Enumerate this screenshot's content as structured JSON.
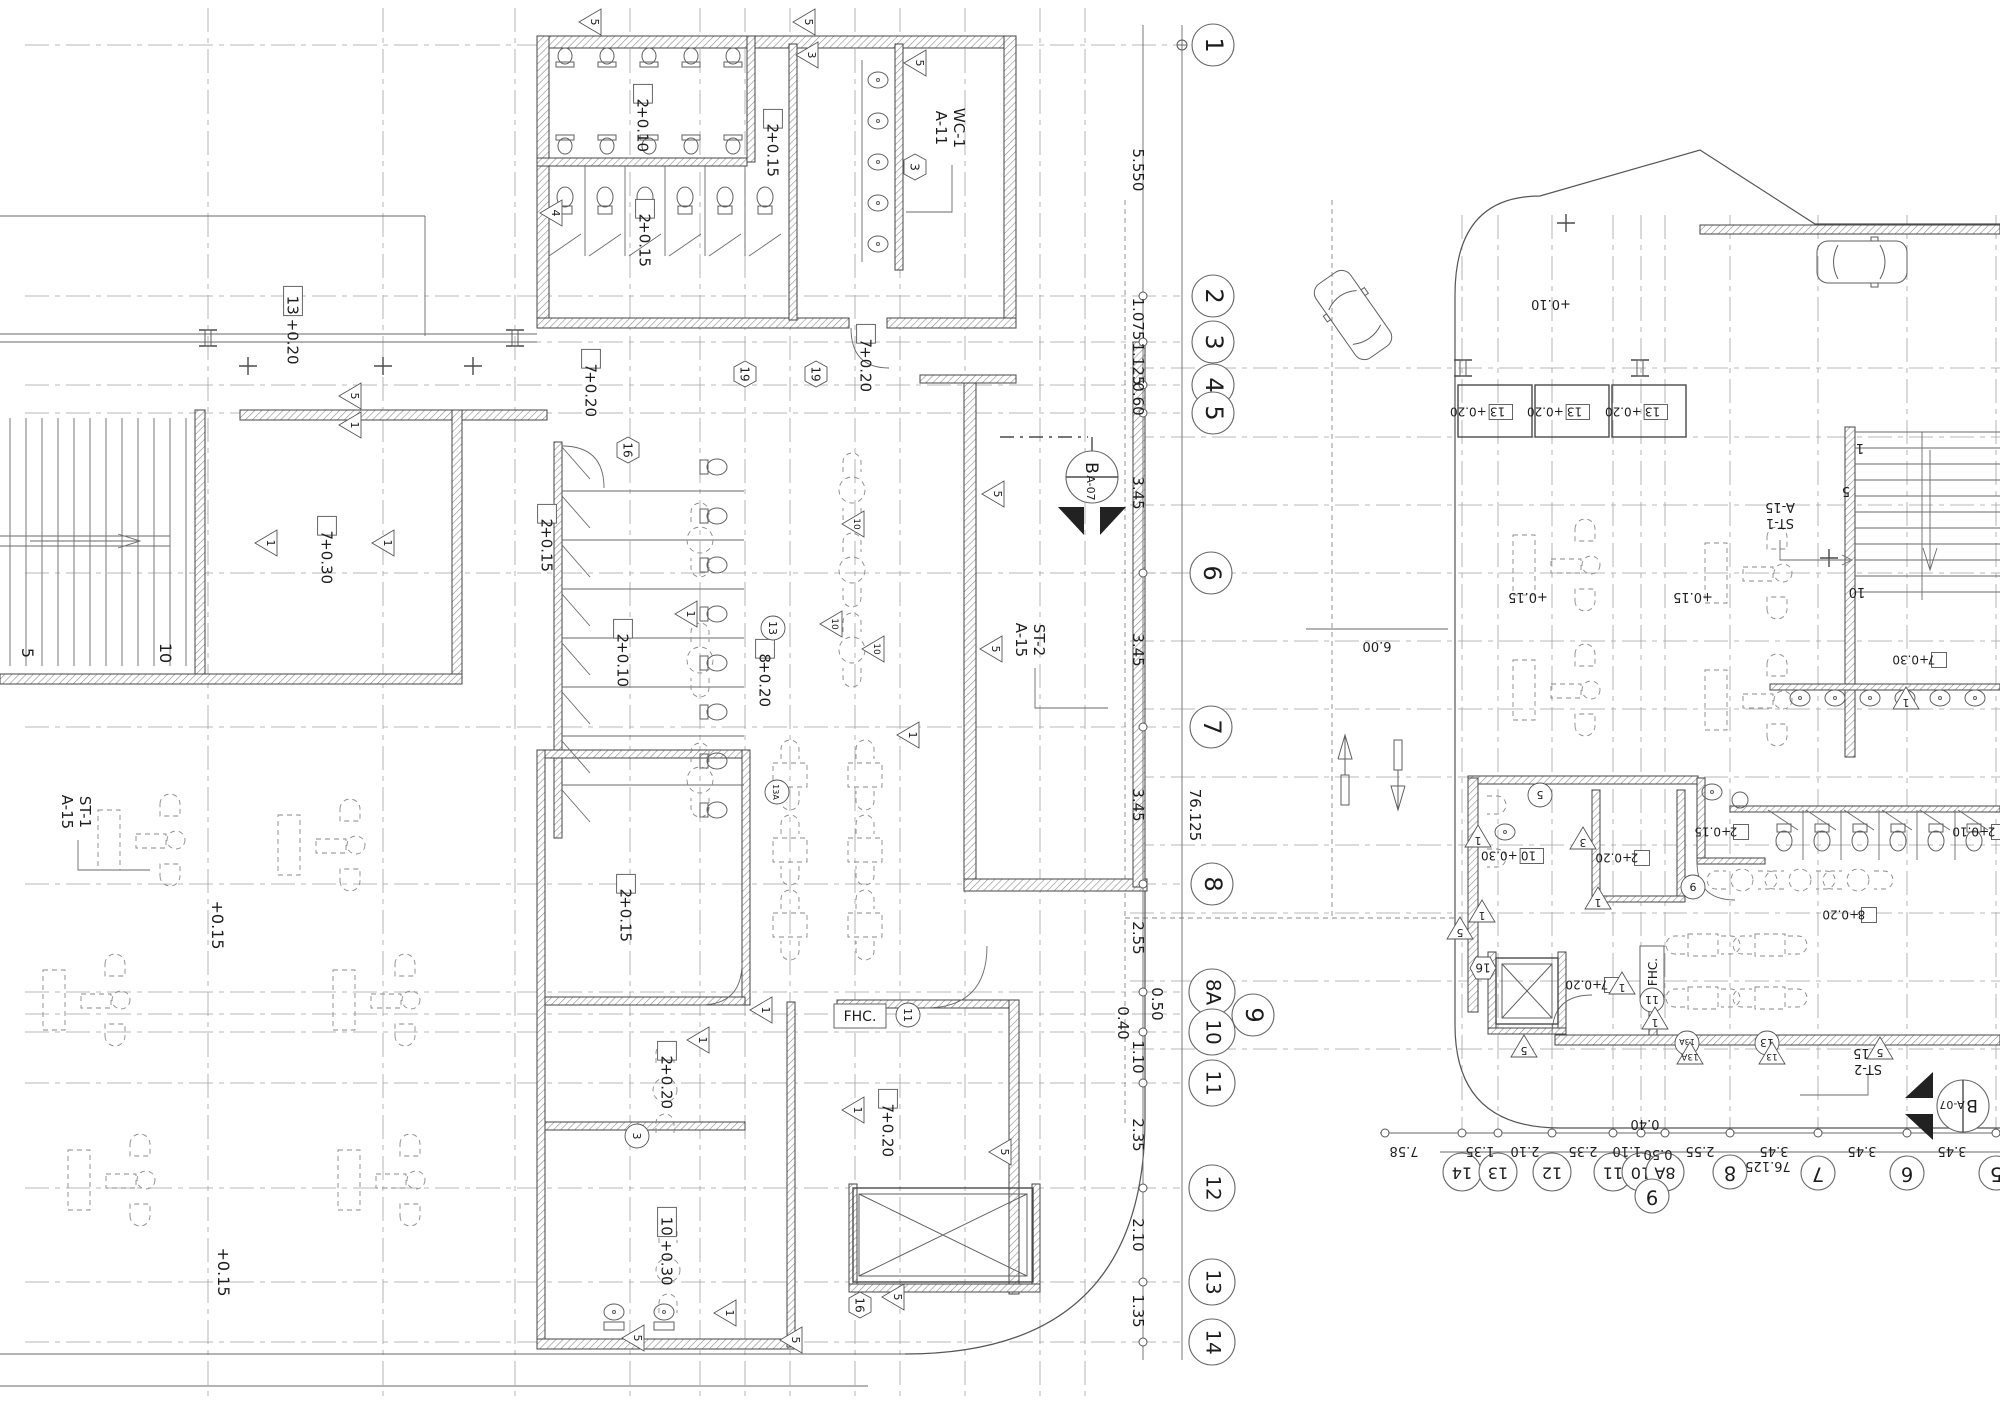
{
  "drawing": {
    "left_plan": {
      "grid_bubbles": [
        {
          "n": "1",
          "x": 1213,
          "y": 45
        },
        {
          "n": "2",
          "x": 1213,
          "y": 296
        },
        {
          "n": "3",
          "x": 1213,
          "y": 342
        },
        {
          "n": "4",
          "x": 1213,
          "y": 385
        },
        {
          "n": "5",
          "x": 1213,
          "y": 413
        },
        {
          "n": "6",
          "x": 1211,
          "y": 573
        },
        {
          "n": "7",
          "x": 1211,
          "y": 727
        },
        {
          "n": "8",
          "x": 1212,
          "y": 884
        },
        {
          "n": "8A",
          "x": 1212,
          "y": 992
        },
        {
          "n": "9",
          "x": 1253,
          "y": 1015
        },
        {
          "n": "10",
          "x": 1212,
          "y": 1032
        },
        {
          "n": "11",
          "x": 1212,
          "y": 1083
        },
        {
          "n": "12",
          "x": 1212,
          "y": 1188
        },
        {
          "n": "13",
          "x": 1212,
          "y": 1282
        },
        {
          "n": "14",
          "x": 1212,
          "y": 1342
        }
      ],
      "dim_labels": [
        {
          "t": "5.550",
          "x": 1133,
          "y": 170
        },
        {
          "t": "1.075",
          "x": 1133,
          "y": 319
        },
        {
          "t": "1.125",
          "x": 1133,
          "y": 364
        },
        {
          "t": "0.60",
          "x": 1133,
          "y": 399
        },
        {
          "t": "3.45",
          "x": 1133,
          "y": 493
        },
        {
          "t": "3.45",
          "x": 1133,
          "y": 650
        },
        {
          "t": "3.45",
          "x": 1133,
          "y": 805
        },
        {
          "t": "2.55",
          "x": 1133,
          "y": 938
        },
        {
          "t": "0.50",
          "x": 1152,
          "y": 1004
        },
        {
          "t": "0.40",
          "x": 1118,
          "y": 1023
        },
        {
          "t": "1.10",
          "x": 1133,
          "y": 1057
        },
        {
          "t": "2.35",
          "x": 1133,
          "y": 1135
        },
        {
          "t": "2.10",
          "x": 1133,
          "y": 1235
        },
        {
          "t": "1.35",
          "x": 1133,
          "y": 1311
        }
      ],
      "overall_dim": {
        "t": "76.125",
        "x": 1190,
        "y": 815
      },
      "elev_labels": [
        {
          "box": "13",
          "t": "+0.20",
          "x": 293,
          "y": 307
        },
        {
          "box": "2",
          "t": "+0.10",
          "x": 643,
          "y": 105
        },
        {
          "box": "2",
          "t": "+0.15",
          "x": 773,
          "y": 130
        },
        {
          "box": "2",
          "t": "+0.15",
          "x": 645,
          "y": 220
        },
        {
          "box": "7",
          "t": "+0.20",
          "x": 591,
          "y": 370
        },
        {
          "box": "7",
          "t": "+0.20",
          "x": 866,
          "y": 345
        },
        {
          "box": "2",
          "t": "+0.15",
          "x": 547,
          "y": 525
        },
        {
          "box": "7",
          "t": "+0.30",
          "x": 327,
          "y": 537
        },
        {
          "box": "2",
          "t": "+0.10",
          "x": 623,
          "y": 640
        },
        {
          "box": "8",
          "t": "+0.20",
          "x": 765,
          "y": 660
        },
        {
          "box": "2",
          "t": "+0.15",
          "x": 626,
          "y": 895
        },
        {
          "box": "2",
          "t": "+0.20",
          "x": 667,
          "y": 1062
        },
        {
          "box": "7",
          "t": "+0.20",
          "x": 888,
          "y": 1110
        },
        {
          "box": "10",
          "t": "+0.30",
          "x": 667,
          "y": 1228
        }
      ],
      "plain_labels": [
        {
          "t": "+0.15",
          "x": 212,
          "y": 925
        },
        {
          "t": "+0.15",
          "x": 218,
          "y": 1272
        },
        {
          "t": "5",
          "x": 22,
          "y": 653
        },
        {
          "t": "10",
          "x": 160,
          "y": 653
        }
      ],
      "ref_labels": [
        {
          "l1": "WC-1",
          "l2": "A-11",
          "x": 952,
          "y": 128
        },
        {
          "l1": "ST-2",
          "l2": "A-15",
          "x": 1032,
          "y": 640
        },
        {
          "l1": "ST-1",
          "l2": "A-15",
          "x": 78,
          "y": 812
        }
      ],
      "box_labels": [
        {
          "t": "FHC.",
          "x": 860,
          "y": 1016
        }
      ],
      "hex_tags": [
        {
          "t": "3",
          "x": 915,
          "y": 167
        },
        {
          "t": "19",
          "x": 745,
          "y": 374
        },
        {
          "t": "19",
          "x": 816,
          "y": 374
        },
        {
          "t": "16",
          "x": 628,
          "y": 450
        },
        {
          "t": "16",
          "x": 860,
          "y": 1305
        }
      ],
      "circle_tags": [
        {
          "t": "11",
          "x": 908,
          "y": 1015
        },
        {
          "t": "3",
          "x": 637,
          "y": 1136
        },
        {
          "t": "13",
          "x": 773,
          "y": 628
        },
        {
          "t": "13A",
          "x": 777,
          "y": 792
        }
      ],
      "tri_tags": [
        {
          "t": "5",
          "x": 592,
          "y": 22
        },
        {
          "t": "5",
          "x": 806,
          "y": 22
        },
        {
          "t": "3",
          "x": 809,
          "y": 55
        },
        {
          "t": "5",
          "x": 917,
          "y": 63
        },
        {
          "t": "4",
          "x": 553,
          "y": 213
        },
        {
          "t": "5",
          "x": 352,
          "y": 396
        },
        {
          "t": "1",
          "x": 352,
          "y": 425
        },
        {
          "t": "1",
          "x": 268,
          "y": 543
        },
        {
          "t": "1",
          "x": 385,
          "y": 543
        },
        {
          "t": "1",
          "x": 688,
          "y": 614
        },
        {
          "t": "10",
          "x": 855,
          "y": 524
        },
        {
          "t": "10",
          "x": 833,
          "y": 624
        },
        {
          "t": "10",
          "x": 875,
          "y": 649
        },
        {
          "t": "5",
          "x": 995,
          "y": 494
        },
        {
          "t": "5",
          "x": 993,
          "y": 649
        },
        {
          "t": "1",
          "x": 910,
          "y": 735
        },
        {
          "t": "1",
          "x": 763,
          "y": 1010
        },
        {
          "t": "1",
          "x": 700,
          "y": 1040
        },
        {
          "t": "1",
          "x": 855,
          "y": 1110
        },
        {
          "t": "5",
          "x": 1002,
          "y": 1152
        },
        {
          "t": "1",
          "x": 727,
          "y": 1313
        },
        {
          "t": "5",
          "x": 635,
          "y": 1338
        },
        {
          "t": "5",
          "x": 793,
          "y": 1340
        },
        {
          "t": "5",
          "x": 895,
          "y": 1297
        }
      ],
      "section_marker": {
        "top": "B",
        "bottom": "A-07",
        "x": 1092,
        "y": 477
      }
    },
    "right_plan": {
      "grid_bubbles": [
        {
          "n": "14",
          "x": 1462,
          "y": 1172
        },
        {
          "n": "13",
          "x": 1498,
          "y": 1172
        },
        {
          "n": "12",
          "x": 1552,
          "y": 1172
        },
        {
          "n": "11",
          "x": 1613,
          "y": 1172
        },
        {
          "n": "10",
          "x": 1641,
          "y": 1172
        },
        {
          "n": "8A",
          "x": 1665,
          "y": 1172
        },
        {
          "n": "9",
          "x": 1652,
          "y": 1196
        },
        {
          "n": "8",
          "x": 1730,
          "y": 1172
        },
        {
          "n": "7",
          "x": 1818,
          "y": 1173
        },
        {
          "n": "6",
          "x": 1907,
          "y": 1173
        },
        {
          "n": "5",
          "x": 1996,
          "y": 1173
        }
      ],
      "dim_labels": [
        {
          "t": "7.58",
          "x": 1404,
          "y": 1147
        },
        {
          "t": "1.35",
          "x": 1480,
          "y": 1147
        },
        {
          "t": "2.10",
          "x": 1525,
          "y": 1147
        },
        {
          "t": "2.35",
          "x": 1583,
          "y": 1147
        },
        {
          "t": "1.10",
          "x": 1627,
          "y": 1147
        },
        {
          "t": "0.40",
          "x": 1645,
          "y": 1120
        },
        {
          "t": "0.50",
          "x": 1658,
          "y": 1150
        },
        {
          "t": "2.55",
          "x": 1700,
          "y": 1147
        },
        {
          "t": "3.45",
          "x": 1774,
          "y": 1147
        },
        {
          "t": "3.45",
          "x": 1862,
          "y": 1147
        },
        {
          "t": "3.45",
          "x": 1952,
          "y": 1147
        }
      ],
      "overall_dim": {
        "t": "76.125",
        "x": 1768,
        "y": 1162
      },
      "elev_labels": [
        {
          "box": "13",
          "t": "+0.20",
          "x": 1496,
          "y": 412
        },
        {
          "box": "13",
          "t": "+0.20",
          "x": 1573,
          "y": 412
        },
        {
          "box": "13",
          "t": "+0.20",
          "x": 1651,
          "y": 412
        },
        {
          "box": "7",
          "t": "+0.30",
          "x": 1930,
          "y": 660
        },
        {
          "box": "10",
          "t": "+0.30",
          "x": 1527,
          "y": 856
        },
        {
          "box": "2",
          "t": "+0.20",
          "x": 1633,
          "y": 858
        },
        {
          "box": "2",
          "t": "+0.15",
          "x": 1732,
          "y": 832
        },
        {
          "box": "2",
          "t": "+0.10",
          "x": 1990,
          "y": 832
        },
        {
          "box": "8",
          "t": "+0.20",
          "x": 1860,
          "y": 915
        },
        {
          "box": "7",
          "t": "+0.20",
          "x": 1603,
          "y": 985
        }
      ],
      "plain_labels": [
        {
          "t": "+0.10",
          "x": 1551,
          "y": 300
        },
        {
          "t": "+0.15",
          "x": 1528,
          "y": 593
        },
        {
          "t": "+0.15",
          "x": 1693,
          "y": 593
        },
        {
          "t": "6.00",
          "x": 1377,
          "y": 642
        },
        {
          "t": "1",
          "x": 1860,
          "y": 444
        },
        {
          "t": "5",
          "x": 1846,
          "y": 487
        },
        {
          "t": "10",
          "x": 1857,
          "y": 588
        }
      ],
      "ref_labels": [
        {
          "l1": "ST-1",
          "l2": "A-15",
          "x": 1780,
          "y": 517
        },
        {
          "l1": "ST-2",
          "l2": "A-15",
          "x": 1868,
          "y": 1063
        }
      ],
      "box_labels": [
        {
          "t": "FHC.",
          "x": 1652,
          "y": 972
        }
      ],
      "hex_tags": [
        {
          "t": "16",
          "x": 1483,
          "y": 968
        }
      ],
      "circle_tags": [
        {
          "t": "9",
          "x": 1693,
          "y": 887
        },
        {
          "t": "11",
          "x": 1652,
          "y": 1000
        },
        {
          "t": "13",
          "x": 1767,
          "y": 1043
        },
        {
          "t": "13A",
          "x": 1687,
          "y": 1043
        },
        {
          "t": "5",
          "x": 1540,
          "y": 795
        }
      ],
      "tri_tags": [
        {
          "t": "1",
          "x": 1478,
          "y": 838
        },
        {
          "t": "1",
          "x": 1482,
          "y": 913
        },
        {
          "t": "5",
          "x": 1460,
          "y": 930
        },
        {
          "t": "3",
          "x": 1583,
          "y": 840
        },
        {
          "t": "1",
          "x": 1598,
          "y": 900
        },
        {
          "t": "1",
          "x": 1655,
          "y": 1020
        },
        {
          "t": "1",
          "x": 1622,
          "y": 985
        },
        {
          "t": "5",
          "x": 1524,
          "y": 1048
        },
        {
          "t": "13A",
          "x": 1690,
          "y": 1055
        },
        {
          "t": "13",
          "x": 1772,
          "y": 1055
        },
        {
          "t": "5",
          "x": 1880,
          "y": 1050
        },
        {
          "t": "1",
          "x": 1906,
          "y": 700
        }
      ],
      "section_marker": {
        "top": "B",
        "bottom": "A-07",
        "x": 1963,
        "y": 1106
      }
    }
  }
}
